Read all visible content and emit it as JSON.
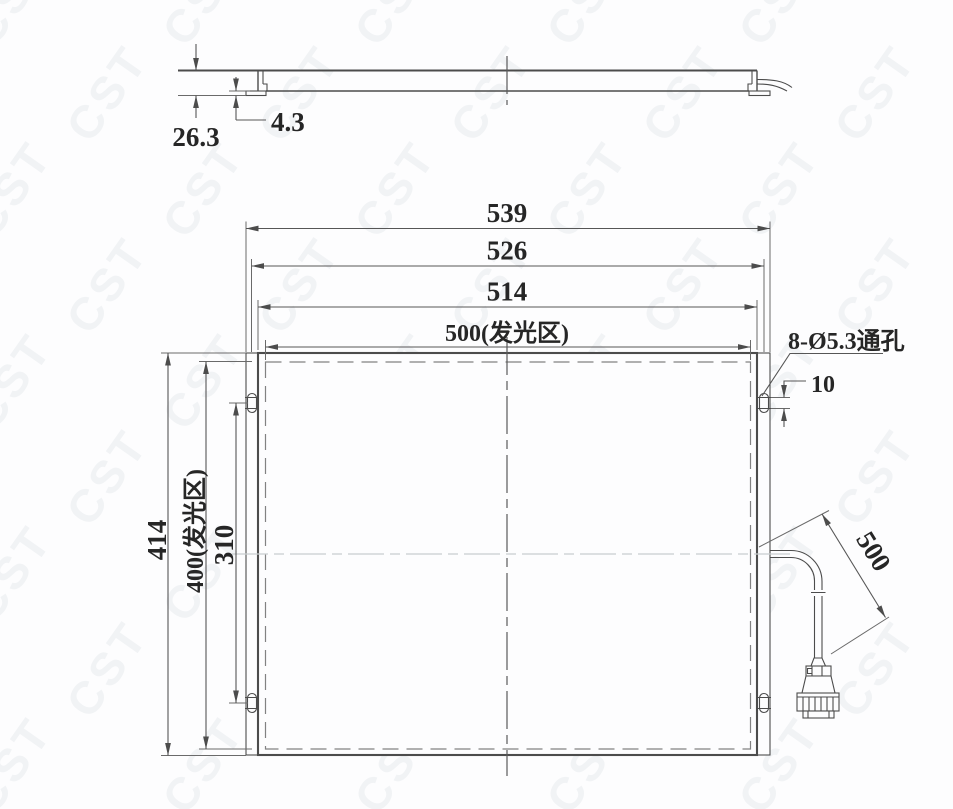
{
  "drawing": {
    "watermark_text": "CST",
    "side_view": {
      "thickness_total": "26.3",
      "bracket_step": "4.3"
    },
    "front_view": {
      "width_overall": "539",
      "width_mount_holes": "526",
      "width_frame": "514",
      "width_luminous": "500(发光区)",
      "height_overall": "414",
      "height_luminous": "400(发光区)",
      "hole_spacing_vertical": "310",
      "hole_callout": "8-Ø5.3通孔",
      "slot_length": "10",
      "cable_length": "500"
    }
  }
}
